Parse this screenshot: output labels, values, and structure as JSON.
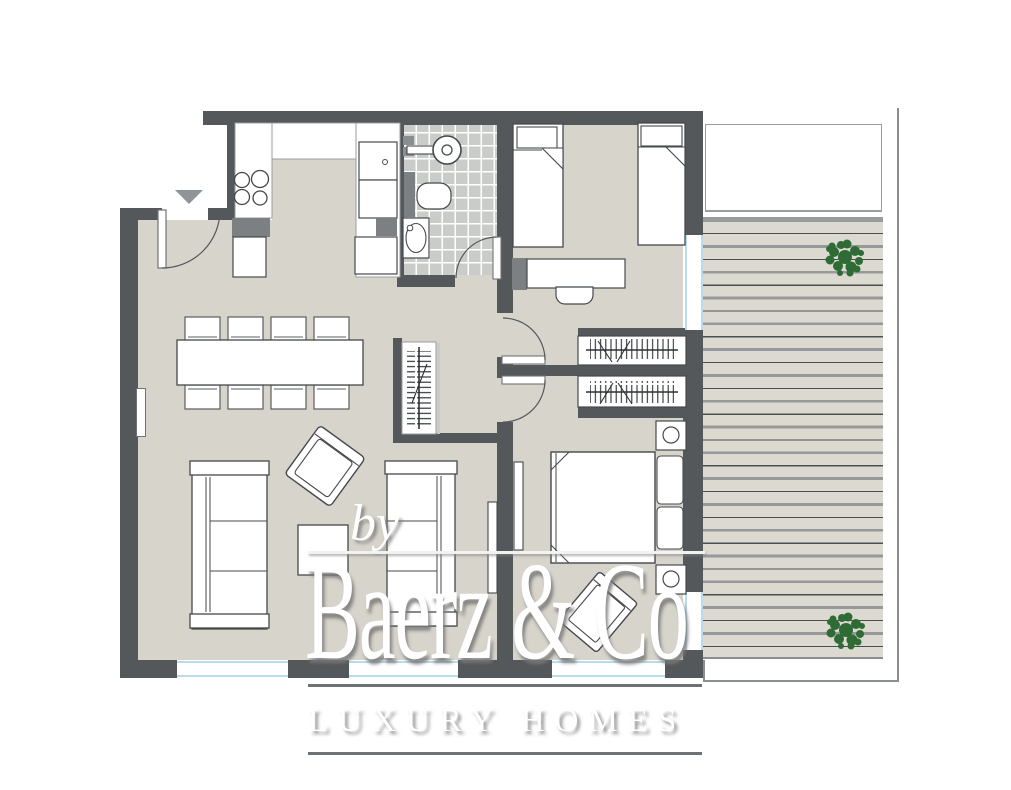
{
  "watermark": {
    "by": "by",
    "brand": "Baerz & Co",
    "tagline": "LUXURY HOMES"
  },
  "palette": {
    "wall": "#54585b",
    "floor": "#d7d4cb",
    "bathroom_tile": "#c9ccc8",
    "deck": "#dcd9d1",
    "glazing_blue": "#b9dcea",
    "plant_green": "#2e6b35",
    "appliance_gray": "#7c8083",
    "entrance_marker_gray": "#8e9497",
    "furniture_outline": "#45494c",
    "watermark_white": "#ffffff"
  },
  "icons": [
    "entrance-arrow-icon",
    "door-swing-icon",
    "plant-icon",
    "shower-icon",
    "toilet-icon",
    "sink-icon",
    "stove-burners-icon",
    "wardrobe-rail-icon",
    "bed-icon",
    "sofa-icon",
    "dining-set-icon"
  ]
}
